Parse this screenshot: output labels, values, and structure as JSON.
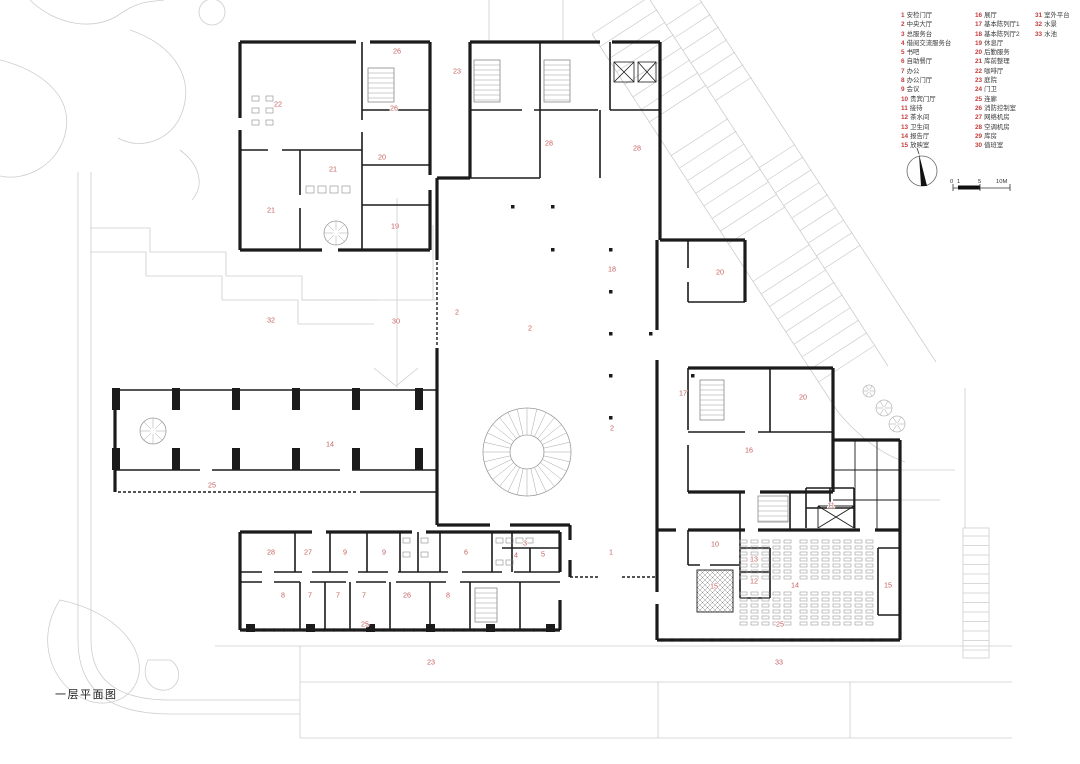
{
  "title": "一层平面图",
  "colors": {
    "wall": "#1b1b1b",
    "site_gray": "#c9c9c9",
    "detail_gray": "#9b9b9b",
    "marker_red": "#c75f5f",
    "legend_red": "#c43c3c"
  },
  "scale_bar": {
    "labels": [
      "0",
      "1",
      "5",
      "10M"
    ]
  },
  "legend": {
    "columns": [
      {
        "items": [
          {
            "num": "1",
            "label": "安检门厅"
          },
          {
            "num": "2",
            "label": "中央大厅"
          },
          {
            "num": "3",
            "label": "总服务台"
          },
          {
            "num": "4",
            "label": "借阅交流服务台"
          },
          {
            "num": "5",
            "label": "书吧"
          },
          {
            "num": "6",
            "label": "自助餐厅"
          },
          {
            "num": "7",
            "label": "办公"
          },
          {
            "num": "8",
            "label": "办公门厅"
          },
          {
            "num": "9",
            "label": "会议"
          },
          {
            "num": "10",
            "label": "贵宾门厅"
          },
          {
            "num": "11",
            "label": "接待"
          },
          {
            "num": "12",
            "label": "茶水间"
          },
          {
            "num": "13",
            "label": "卫生间"
          },
          {
            "num": "14",
            "label": "报告厅"
          },
          {
            "num": "15",
            "label": "放映室"
          }
        ]
      },
      {
        "items": [
          {
            "num": "16",
            "label": "展厅"
          },
          {
            "num": "17",
            "label": "基本陈列厅1"
          },
          {
            "num": "18",
            "label": "基本陈列厅2"
          },
          {
            "num": "19",
            "label": "休息厅"
          },
          {
            "num": "20",
            "label": "后勤服务"
          },
          {
            "num": "21",
            "label": "库前整理"
          },
          {
            "num": "22",
            "label": "咖啡厅"
          },
          {
            "num": "23",
            "label": "庭院"
          },
          {
            "num": "24",
            "label": "门卫"
          },
          {
            "num": "25",
            "label": "连廊"
          },
          {
            "num": "26",
            "label": "消防控制室"
          },
          {
            "num": "27",
            "label": "网络机房"
          },
          {
            "num": "28",
            "label": "空调机房"
          },
          {
            "num": "29",
            "label": "库房"
          },
          {
            "num": "30",
            "label": "值班室"
          }
        ]
      },
      {
        "items": [
          {
            "num": "31",
            "label": "室外平台"
          },
          {
            "num": "32",
            "label": "水景"
          },
          {
            "num": "33",
            "label": "水池"
          }
        ]
      }
    ]
  },
  "plan_markers": [
    {
      "n": "26",
      "x": 397,
      "y": 51
    },
    {
      "n": "23",
      "x": 457,
      "y": 71
    },
    {
      "n": "22",
      "x": 278,
      "y": 104
    },
    {
      "n": "26",
      "x": 394,
      "y": 108
    },
    {
      "n": "28",
      "x": 549,
      "y": 143
    },
    {
      "n": "28",
      "x": 637,
      "y": 148
    },
    {
      "n": "20",
      "x": 382,
      "y": 157
    },
    {
      "n": "21",
      "x": 333,
      "y": 169
    },
    {
      "n": "21",
      "x": 271,
      "y": 210
    },
    {
      "n": "19",
      "x": 395,
      "y": 226
    },
    {
      "n": "18",
      "x": 612,
      "y": 269
    },
    {
      "n": "20",
      "x": 720,
      "y": 272
    },
    {
      "n": "2",
      "x": 457,
      "y": 312
    },
    {
      "n": "32",
      "x": 271,
      "y": 320
    },
    {
      "n": "30",
      "x": 396,
      "y": 321
    },
    {
      "n": "2",
      "x": 530,
      "y": 328
    },
    {
      "n": "17",
      "x": 683,
      "y": 393
    },
    {
      "n": "20",
      "x": 803,
      "y": 397
    },
    {
      "n": "2",
      "x": 612,
      "y": 428
    },
    {
      "n": "14",
      "x": 330,
      "y": 444
    },
    {
      "n": "16",
      "x": 749,
      "y": 450
    },
    {
      "n": "25",
      "x": 212,
      "y": 485
    },
    {
      "n": "11",
      "x": 831,
      "y": 505
    },
    {
      "n": "3",
      "x": 525,
      "y": 543
    },
    {
      "n": "10",
      "x": 715,
      "y": 544
    },
    {
      "n": "1",
      "x": 611,
      "y": 552
    },
    {
      "n": "28",
      "x": 271,
      "y": 552
    },
    {
      "n": "27",
      "x": 308,
      "y": 552
    },
    {
      "n": "9",
      "x": 345,
      "y": 552
    },
    {
      "n": "9",
      "x": 384,
      "y": 552
    },
    {
      "n": "6",
      "x": 466,
      "y": 552
    },
    {
      "n": "4",
      "x": 516,
      "y": 555
    },
    {
      "n": "5",
      "x": 543,
      "y": 554
    },
    {
      "n": "13",
      "x": 754,
      "y": 559
    },
    {
      "n": "12",
      "x": 754,
      "y": 581
    },
    {
      "n": "14",
      "x": 795,
      "y": 585
    },
    {
      "n": "15",
      "x": 888,
      "y": 585
    },
    {
      "n": "15",
      "x": 714,
      "y": 586
    },
    {
      "n": "8",
      "x": 283,
      "y": 595
    },
    {
      "n": "7",
      "x": 310,
      "y": 595
    },
    {
      "n": "7",
      "x": 338,
      "y": 595
    },
    {
      "n": "7",
      "x": 364,
      "y": 595
    },
    {
      "n": "26",
      "x": 407,
      "y": 595
    },
    {
      "n": "8",
      "x": 448,
      "y": 595
    },
    {
      "n": "25",
      "x": 365,
      "y": 624
    },
    {
      "n": "25",
      "x": 780,
      "y": 624
    },
    {
      "n": "23",
      "x": 431,
      "y": 662
    },
    {
      "n": "33",
      "x": 779,
      "y": 662
    }
  ]
}
